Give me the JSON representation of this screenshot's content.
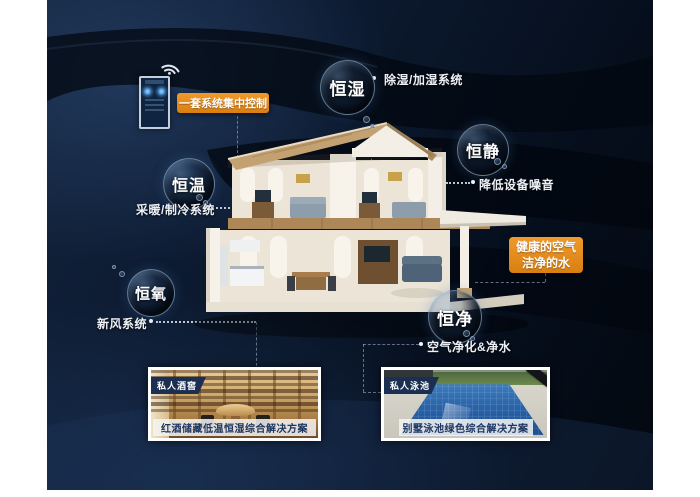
{
  "control": {
    "label": "一套系统集中控制",
    "device": "smart-controller-phone",
    "wifi_icon": "wifi-icon"
  },
  "features": [
    {
      "bubble": "恒湿",
      "label": "除湿/加湿系统"
    },
    {
      "bubble": "恒静",
      "label": "降低设备噪音"
    },
    {
      "bubble": "恒温",
      "label": "采暖/制冷系统"
    },
    {
      "bubble": "恒氧",
      "label": "新风系统"
    },
    {
      "bubble": "恒净",
      "label": "空气净化&净水"
    }
  ],
  "highlight_box": {
    "line1": "健康的空气",
    "line2": "洁净的水"
  },
  "cards": [
    {
      "tag": "私人酒窖",
      "caption": "红酒储藏低温恒湿综合解决方案"
    },
    {
      "tag": "私人泳池",
      "caption": "别墅泳池绿色综合解决方案"
    }
  ],
  "colors": {
    "accent_orange": "#E4881E",
    "panel_navy": "#0C1A30",
    "bubble_text": "#FFFFFF",
    "caption_text": "#1D3560"
  }
}
